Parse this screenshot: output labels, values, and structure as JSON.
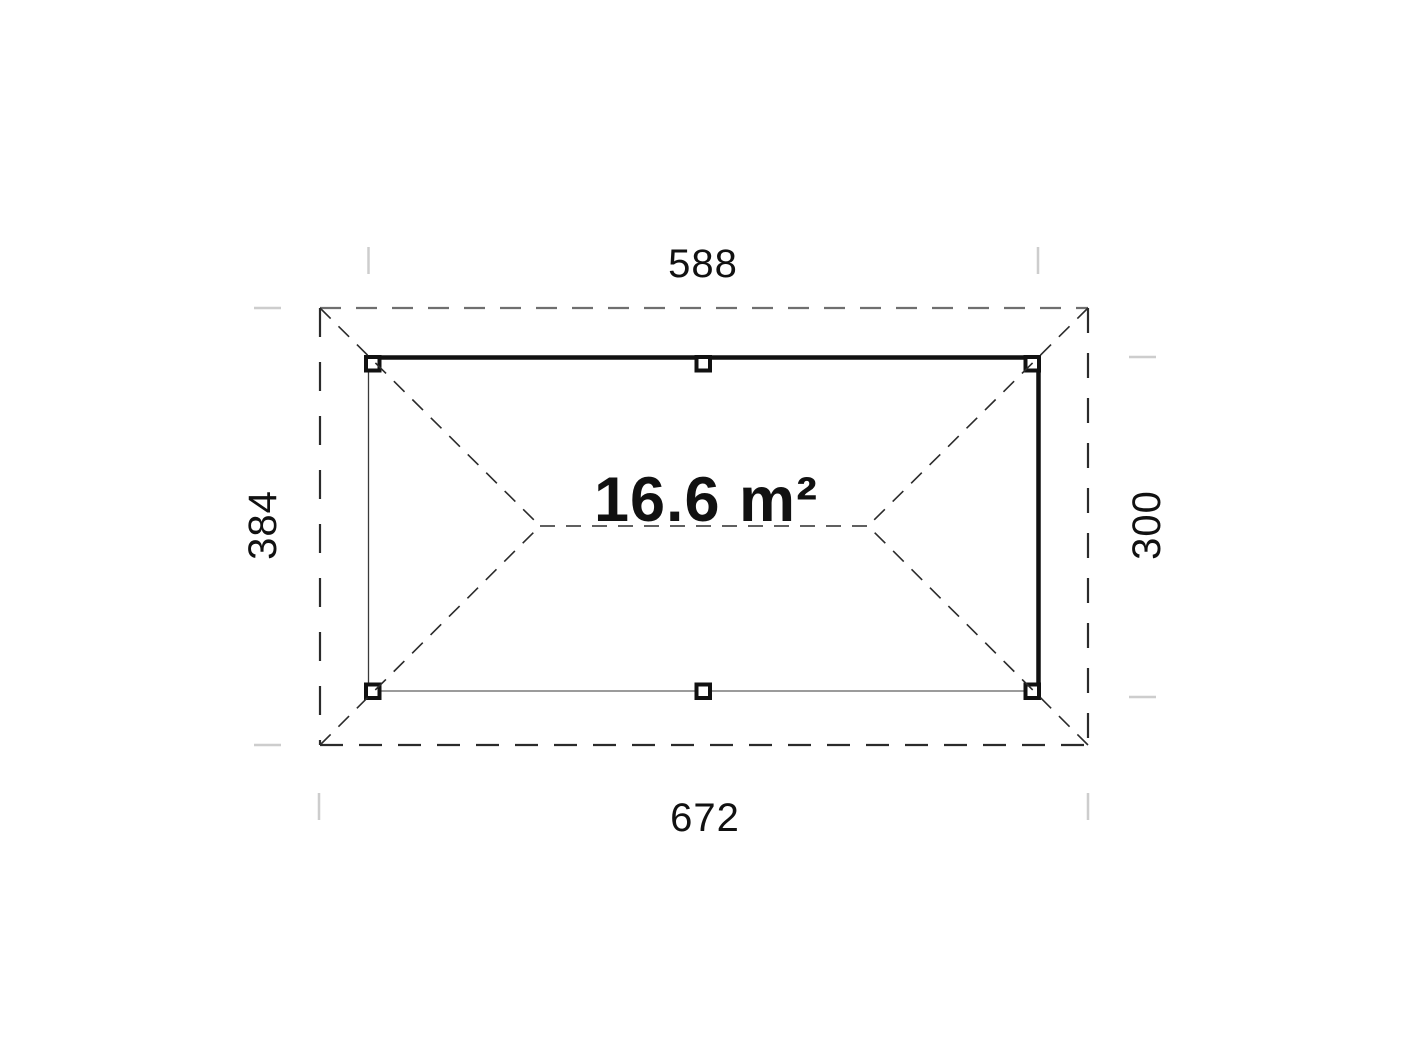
{
  "drawing": {
    "type": "roof-plan",
    "area_label": "16.6 m²",
    "dimensions": {
      "top": "588",
      "bottom": "672",
      "left": "384",
      "right": "300"
    },
    "colors": {
      "beam": "#111111",
      "dashed_outline": "#2b2b2b",
      "dashed_outline_top": "#6f6f6f",
      "thin_edge": "#7a7a7a",
      "extension_tick": "#cdcdcd",
      "background": "#ffffff"
    }
  }
}
